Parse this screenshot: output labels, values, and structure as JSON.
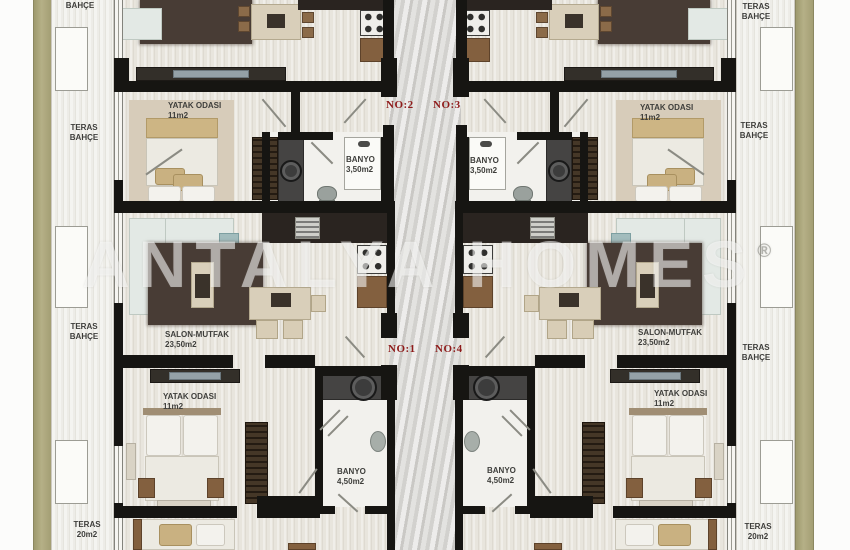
{
  "watermark": {
    "text": "ANTALYA HOMES",
    "mark": "®"
  },
  "units": {
    "no1": "NO:1",
    "no2": "NO:2",
    "no3": "NO:3",
    "no4": "NO:4"
  },
  "rooms": {
    "garden": "BAHÇE",
    "terrace_garden": {
      "line1": "TERAS",
      "line2": "BAHÇE"
    },
    "terrace": {
      "line1": "TERAS",
      "line2": "20m2"
    },
    "bedroom": {
      "line1": "YATAK ODASI",
      "line2": "11m2"
    },
    "bath_small": {
      "line1": "BANYO",
      "line2": "3,50m2"
    },
    "bath_large": {
      "line1": "BANYO",
      "line2": "4,50m2"
    },
    "living": {
      "line1": "SALON-MUTFAK",
      "line2": "23,50m2"
    }
  },
  "colors": {
    "wall": "#161512",
    "unit_number_text": "#8e1a1a",
    "garden_strip": "#a8a378",
    "rug": "#483c35",
    "duvet_khaki": "#cdb584",
    "corridor_marble": "#d7d6d3",
    "floor_wood": "#e8e5dd"
  }
}
